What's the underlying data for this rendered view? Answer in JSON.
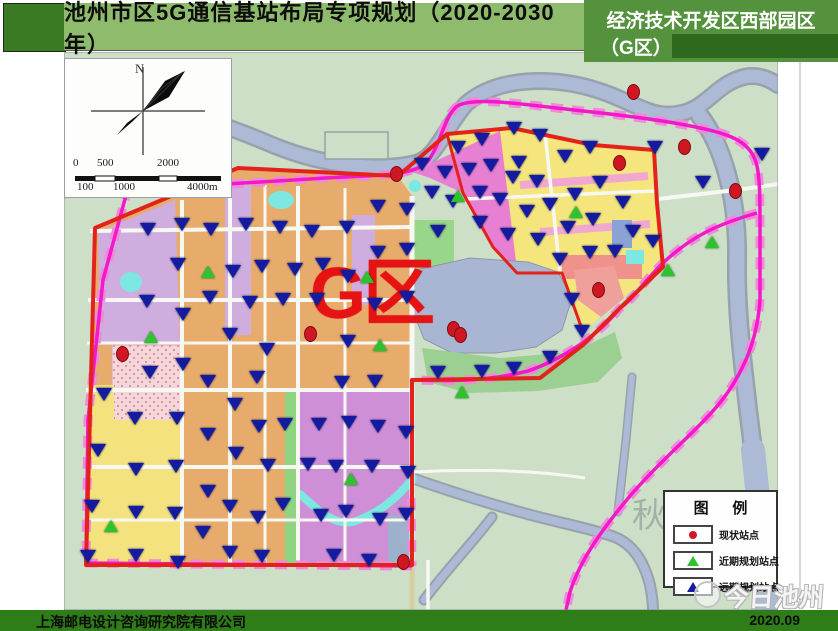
{
  "slide": {
    "title": "池州市区5G通信基站布局专项规划（2020-2030年）",
    "banner_line1": "经济技术开发区西部园区",
    "banner_line2": "（G区）",
    "footer_company": "上海邮电设计咨询研究院有限公司",
    "footer_date": "2020.09",
    "watermark": "今日池州"
  },
  "map": {
    "region_label": "G区",
    "compass_label": "N",
    "faint_label": "秋",
    "scale": {
      "top_labels": [
        "0",
        "500",
        "2000"
      ],
      "bottom_labels": [
        "100",
        "1000",
        "4000m"
      ]
    },
    "legend": {
      "title": "图  例",
      "items": [
        {
          "symbol": "red-dot",
          "label": "现状站点",
          "color": "#ce1722"
        },
        {
          "symbol": "green-triangle",
          "label": "近期规划站点",
          "color": "#2ec32e"
        },
        {
          "symbol": "blue-triangle",
          "label": "远期规划站点",
          "color": "#151b9f"
        }
      ]
    },
    "colors": {
      "header_green": "#8fbb6d",
      "banner_green": "#55923e",
      "footer_green": "#2e7d18",
      "boundary_red": "#e3231a",
      "railway_magenta": "#f318c9",
      "region_label_red": "#e51313"
    },
    "markers": {
      "existing_sites": [
        [
          633,
          91
        ],
        [
          684,
          146
        ],
        [
          619,
          162
        ],
        [
          735,
          190
        ],
        [
          396,
          173
        ],
        [
          598,
          289
        ],
        [
          453,
          328
        ],
        [
          460,
          334
        ],
        [
          310,
          333
        ],
        [
          122,
          353
        ],
        [
          403,
          561
        ]
      ],
      "near_term_sites": [
        [
          208,
          272
        ],
        [
          151,
          337
        ],
        [
          367,
          277
        ],
        [
          380,
          345
        ],
        [
          458,
          196
        ],
        [
          576,
          212
        ],
        [
          712,
          242
        ],
        [
          668,
          270
        ],
        [
          111,
          526
        ],
        [
          351,
          479
        ],
        [
          462,
          392
        ]
      ],
      "long_term_sites": [
        [
          148,
          230
        ],
        [
          182,
          225
        ],
        [
          211,
          230
        ],
        [
          246,
          225
        ],
        [
          280,
          228
        ],
        [
          312,
          232
        ],
        [
          347,
          228
        ],
        [
          378,
          207
        ],
        [
          407,
          210
        ],
        [
          432,
          193
        ],
        [
          422,
          165
        ],
        [
          445,
          173
        ],
        [
          453,
          202
        ],
        [
          469,
          170
        ],
        [
          480,
          193
        ],
        [
          491,
          166
        ],
        [
          500,
          200
        ],
        [
          513,
          178
        ],
        [
          458,
          148
        ],
        [
          482,
          140
        ],
        [
          438,
          232
        ],
        [
          480,
          223
        ],
        [
          508,
          235
        ],
        [
          514,
          129
        ],
        [
          540,
          136
        ],
        [
          519,
          163
        ],
        [
          537,
          182
        ],
        [
          550,
          205
        ],
        [
          565,
          157
        ],
        [
          568,
          228
        ],
        [
          575,
          195
        ],
        [
          590,
          148
        ],
        [
          600,
          183
        ],
        [
          623,
          203
        ],
        [
          633,
          232
        ],
        [
          653,
          242
        ],
        [
          655,
          148
        ],
        [
          703,
          183
        ],
        [
          762,
          155
        ],
        [
          590,
          253
        ],
        [
          615,
          252
        ],
        [
          560,
          260
        ],
        [
          538,
          240
        ],
        [
          527,
          212
        ],
        [
          593,
          220
        ],
        [
          178,
          265
        ],
        [
          233,
          272
        ],
        [
          262,
          267
        ],
        [
          295,
          270
        ],
        [
          323,
          265
        ],
        [
          348,
          277
        ],
        [
          378,
          253
        ],
        [
          407,
          250
        ],
        [
          147,
          302
        ],
        [
          183,
          315
        ],
        [
          210,
          298
        ],
        [
          250,
          303
        ],
        [
          283,
          300
        ],
        [
          317,
          300
        ],
        [
          375,
          305
        ],
        [
          407,
          298
        ],
        [
          572,
          300
        ],
        [
          582,
          332
        ],
        [
          230,
          335
        ],
        [
          267,
          350
        ],
        [
          348,
          342
        ],
        [
          150,
          373
        ],
        [
          183,
          365
        ],
        [
          208,
          382
        ],
        [
          257,
          378
        ],
        [
          342,
          383
        ],
        [
          375,
          382
        ],
        [
          550,
          358
        ],
        [
          514,
          369
        ],
        [
          482,
          372
        ],
        [
          438,
          373
        ],
        [
          104,
          395
        ],
        [
          135,
          419
        ],
        [
          177,
          419
        ],
        [
          98,
          451
        ],
        [
          136,
          470
        ],
        [
          176,
          467
        ],
        [
          208,
          435
        ],
        [
          235,
          405
        ],
        [
          236,
          454
        ],
        [
          259,
          427
        ],
        [
          285,
          425
        ],
        [
          268,
          466
        ],
        [
          319,
          425
        ],
        [
          349,
          423
        ],
        [
          308,
          465
        ],
        [
          336,
          467
        ],
        [
          372,
          467
        ],
        [
          378,
          427
        ],
        [
          406,
          433
        ],
        [
          408,
          473
        ],
        [
          92,
          507
        ],
        [
          136,
          513
        ],
        [
          175,
          514
        ],
        [
          88,
          557
        ],
        [
          136,
          556
        ],
        [
          178,
          563
        ],
        [
          208,
          492
        ],
        [
          230,
          507
        ],
        [
          258,
          518
        ],
        [
          203,
          533
        ],
        [
          230,
          553
        ],
        [
          262,
          557
        ],
        [
          283,
          505
        ],
        [
          321,
          516
        ],
        [
          334,
          556
        ],
        [
          369,
          561
        ],
        [
          380,
          520
        ],
        [
          406,
          515
        ],
        [
          346,
          512
        ]
      ]
    }
  }
}
